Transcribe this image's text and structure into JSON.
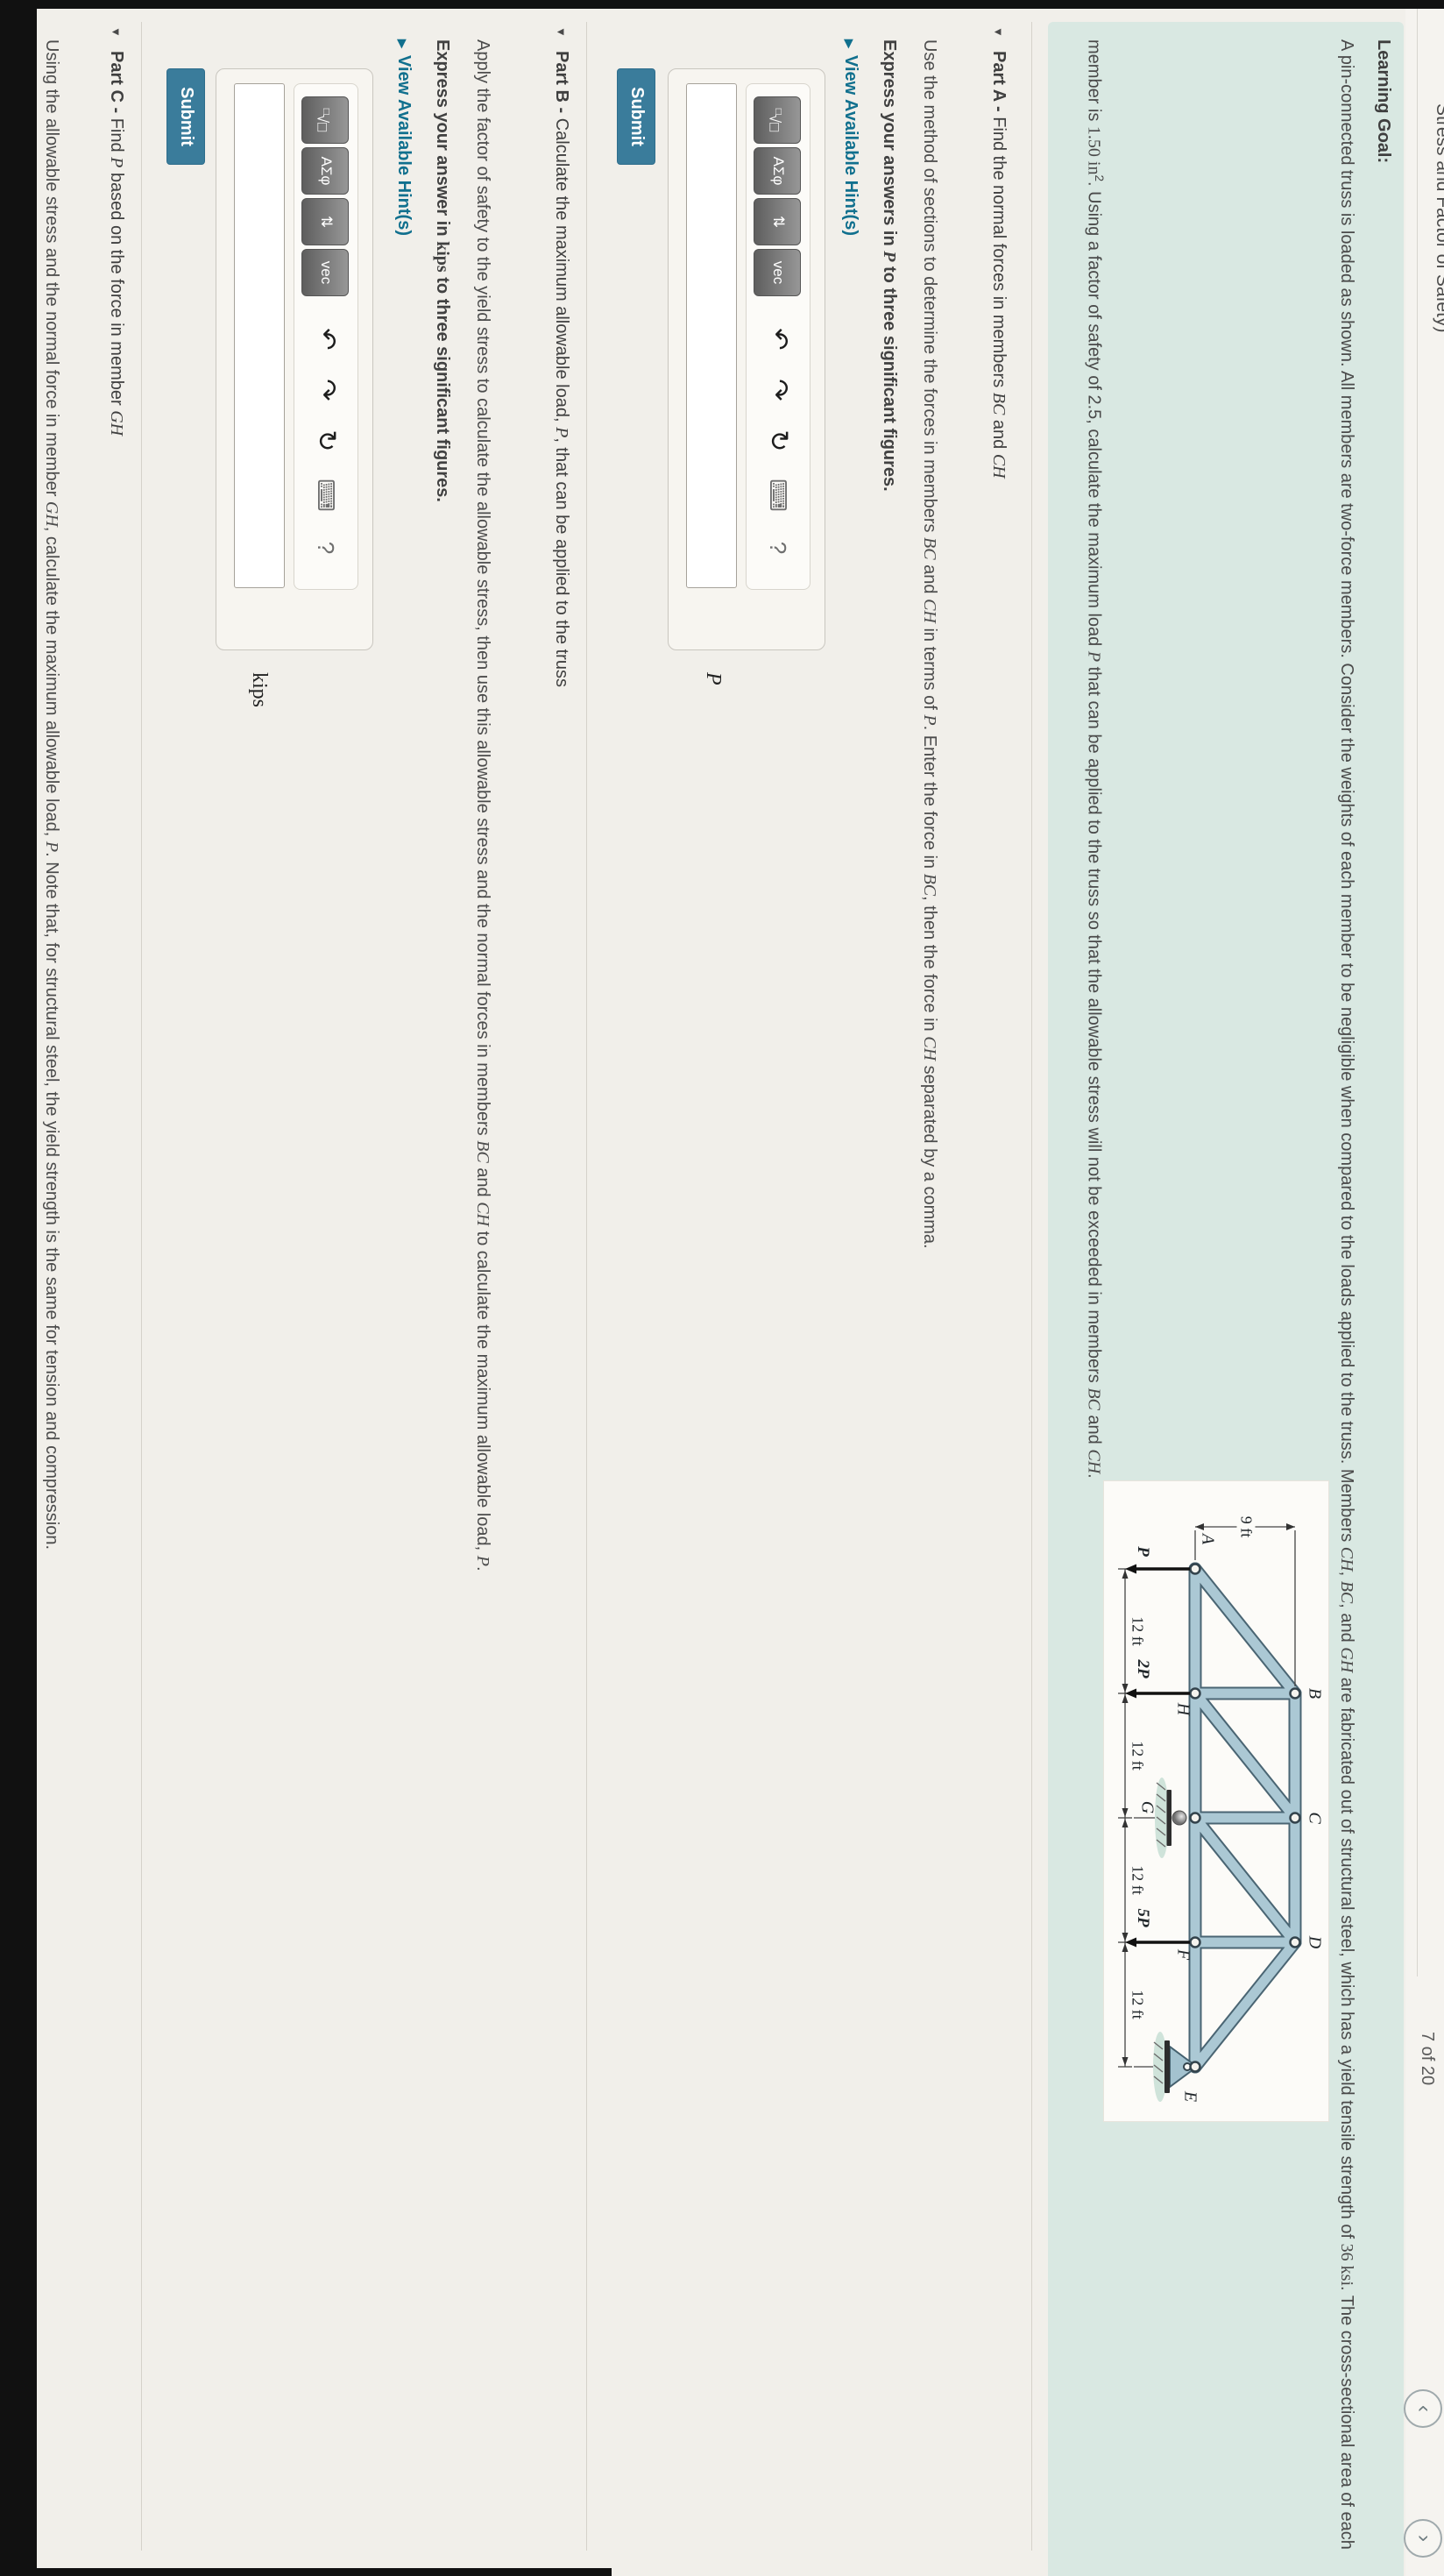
{
  "top_bar": {
    "clipped_title": "Stress and Factor of Safety)",
    "item_count": "7 of 20",
    "prev": "‹",
    "next": "›"
  },
  "ui": {
    "submit": "Submit",
    "hint": "View Available Hint(s)",
    "hint_arrow": "▶",
    "part_marker": "▼"
  },
  "toolbar": {
    "eq_sup": "□",
    "eq_main": "√□",
    "greek": "ΑΣφ",
    "updown": "⇅",
    "vec": "vec",
    "undo": "↶",
    "redo": "↷",
    "reset": "↻",
    "keyboard": "⌨",
    "help": "?"
  },
  "learning_goal": {
    "label": "Learning Goal:",
    "para1": [
      {
        "t": "A pin-connected truss is loaded as shown. All members are two-force members. Consider the weights of each member to be negligible when compared to the loads applied to the truss. Members "
      },
      {
        "t": "CH",
        "st": "mi"
      },
      {
        "t": ", "
      },
      {
        "t": "BC",
        "st": "mi"
      },
      {
        "t": ", and "
      },
      {
        "t": "GH",
        "st": "mi"
      },
      {
        "t": " are fabricated out of structural steel, which has a yield tensile strength of "
      },
      {
        "t": "36 ksi",
        "st": "mr"
      },
      {
        "t": ". The cross-sectional area of each"
      }
    ],
    "para2": [
      {
        "t": "member is "
      },
      {
        "t": "1.50 in",
        "st": "mr"
      },
      {
        "t": "2",
        "sup": true
      },
      {
        "t": ". Using a factor of safety of 2.5, calculate the maximum load "
      },
      {
        "t": "P",
        "st": "mi"
      },
      {
        "t": " that can be applied to the truss so that the allowable stress will not be exceeded in members "
      },
      {
        "t": "BC",
        "st": "mi"
      },
      {
        "t": " and "
      },
      {
        "t": "CH",
        "st": "mi"
      },
      {
        "t": "."
      }
    ]
  },
  "figure": {
    "type": "truss-diagram",
    "labels": {
      "a": "A",
      "b": "B",
      "c": "C",
      "d": "D",
      "e": "E",
      "f": "F",
      "g": "G",
      "h": "H"
    },
    "dim_height": "9 ft",
    "dim_span": "12 ft",
    "loads": {
      "p": "P",
      "p2": "2P",
      "p5": "5P"
    },
    "geometry_notes": {
      "top_chord_nodes": [
        "B",
        "C",
        "D"
      ],
      "bottom_chord_nodes": [
        "A",
        "H",
        "G",
        "F",
        "E"
      ],
      "panel_spacing_ft": 12,
      "height_ft": 9,
      "loads_at": {
        "A": "P",
        "H": "2P",
        "F": "5P"
      },
      "supports": {
        "G": "roller",
        "E": "pin"
      }
    }
  },
  "parts": {
    "a": {
      "label": "Part A - ",
      "title": [
        {
          "t": "Find the normal forces in members "
        },
        {
          "t": "BC",
          "st": "mi"
        },
        {
          "t": " and "
        },
        {
          "t": "CH",
          "st": "mi"
        }
      ],
      "desc": [
        {
          "t": "Use the method of sections to determine the forces in members "
        },
        {
          "t": "BC",
          "st": "mi"
        },
        {
          "t": " and "
        },
        {
          "t": "CH",
          "st": "mi"
        },
        {
          "t": " in terms of "
        },
        {
          "t": "P",
          "st": "mi"
        },
        {
          "t": ". Enter the force in "
        },
        {
          "t": "BC",
          "st": "mi"
        },
        {
          "t": ", then the force in "
        },
        {
          "t": "CH",
          "st": "mi"
        },
        {
          "t": " separated by a comma."
        }
      ],
      "express": [
        {
          "t": "Express your answers in "
        },
        {
          "t": "P",
          "st": "mi"
        },
        {
          "t": " to three significant figures."
        }
      ],
      "unit": "P",
      "input_value": ""
    },
    "b": {
      "label": "Part B - ",
      "title": [
        {
          "t": "Calculate the maximum allowable load, "
        },
        {
          "t": "P",
          "st": "mi"
        },
        {
          "t": ", that can be applied to the truss"
        }
      ],
      "desc": [
        {
          "t": "Apply the factor of safety to the yield stress to calculate the allowable stress, then use this allowable stress and the normal forces in members "
        },
        {
          "t": "BC",
          "st": "mi"
        },
        {
          "t": " and "
        },
        {
          "t": "CH",
          "st": "mi"
        },
        {
          "t": " to calculate the maximum allowable load, "
        },
        {
          "t": "P",
          "st": "mi"
        },
        {
          "t": "."
        }
      ],
      "express": [
        {
          "t": "Express your answer in "
        },
        {
          "t": "kips",
          "st": "mr"
        },
        {
          "t": " to three significant figures."
        }
      ],
      "unit": "kips",
      "input_value": ""
    },
    "c": {
      "label": "Part C - ",
      "title": [
        {
          "t": "Find "
        },
        {
          "t": "P",
          "st": "mi"
        },
        {
          "t": " based on the force in member "
        },
        {
          "t": "GH",
          "st": "mi"
        }
      ],
      "desc": [
        {
          "t": "Using the allowable stress and the normal force in member "
        },
        {
          "t": "GH",
          "st": "mi"
        },
        {
          "t": ", calculate the maximum allowable load, "
        },
        {
          "t": "P",
          "st": "mi"
        },
        {
          "t": ". Note that, for structural steel, the yield strength is the same for tension and compression."
        }
      ]
    }
  },
  "colors": {
    "mint_box": "#d9e8e2",
    "submit": "#3a7c9b",
    "hint_link": "#11708e",
    "steel_member": "#abc8d4",
    "page_bg": "#f1efea"
  }
}
